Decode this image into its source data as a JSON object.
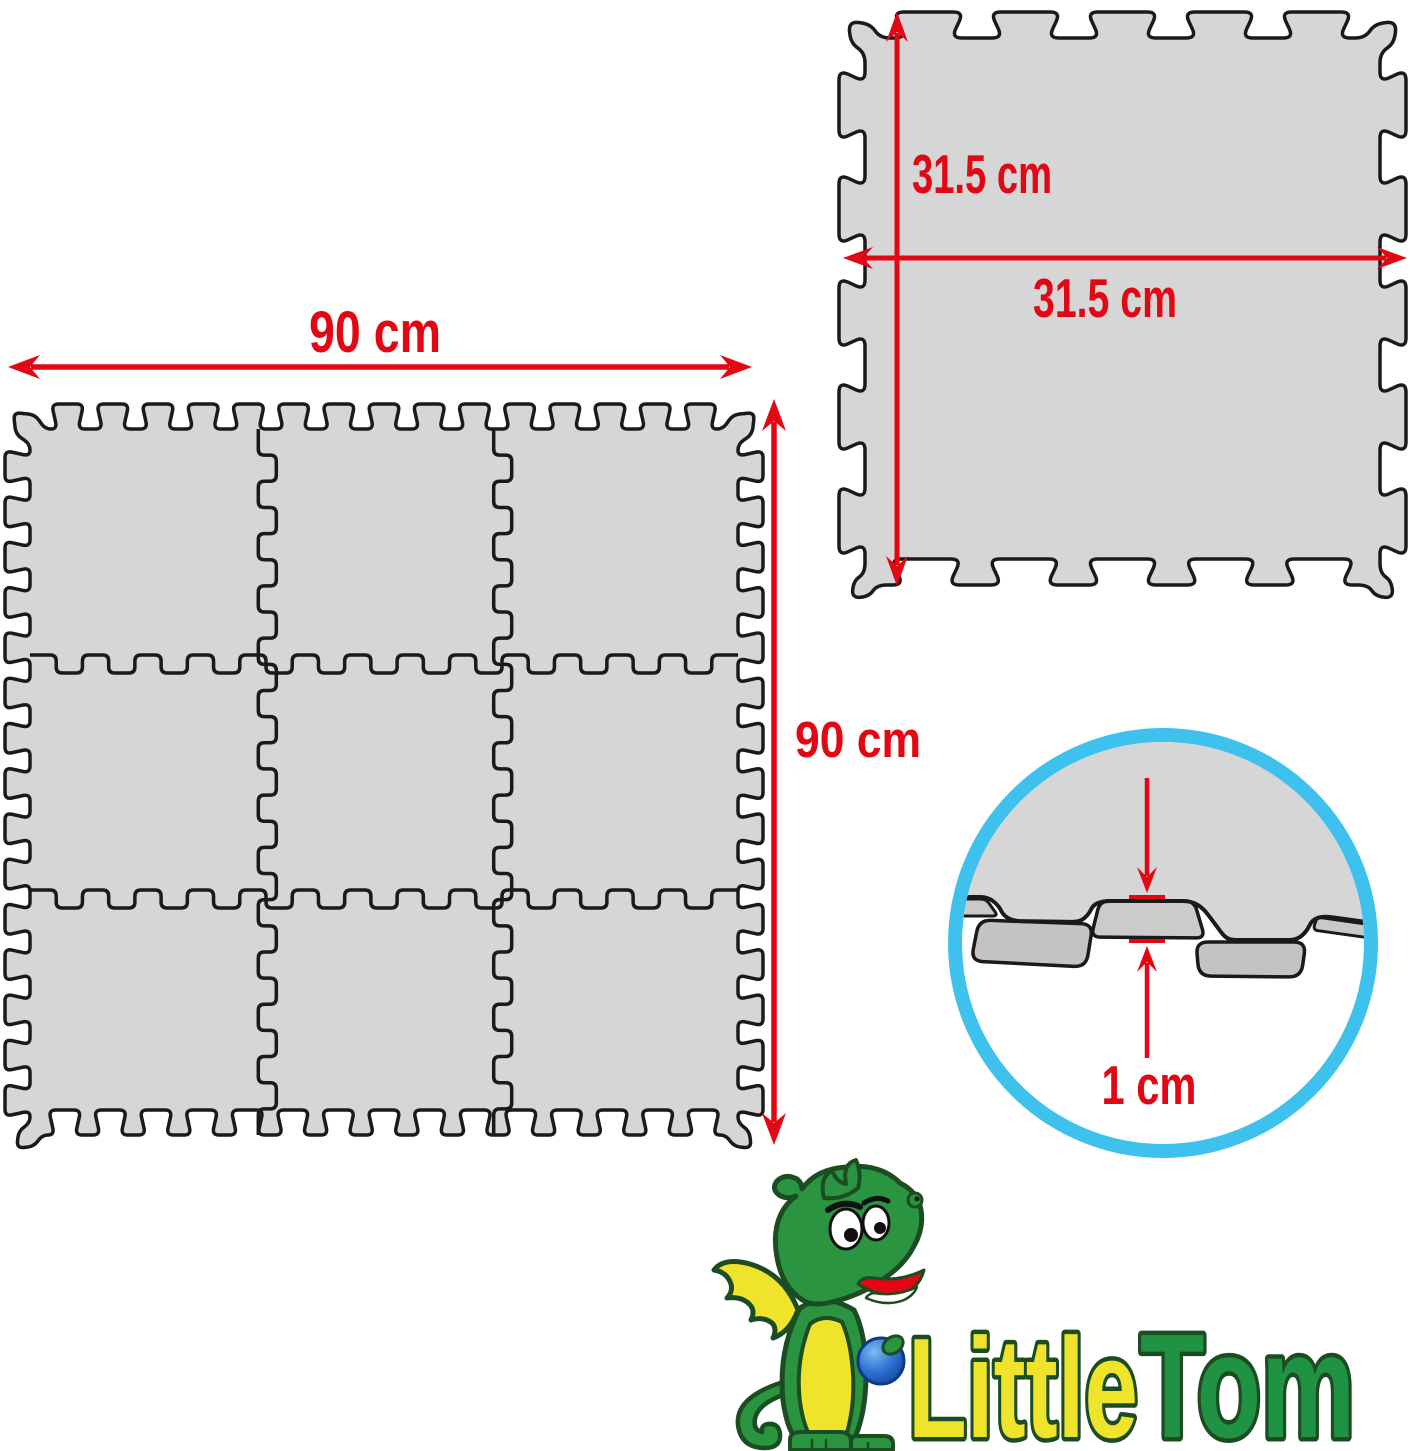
{
  "colors": {
    "background": "#ffffff",
    "red": "#e30613",
    "outline": "#1a1a1a",
    "mat_fill": "#d6d6d6",
    "mat_face": "#c3c3c3",
    "mat_face_mid": "#cbcbcb",
    "mat_strip": "#c9c9c9",
    "circle_blue": "#3fc1ee",
    "logo_green": "#1f9243",
    "logo_dark_green": "#1c4d22",
    "logo_yellow": "#efe32b",
    "dragon_green": "#2a9440",
    "ball_blue": "#1a5fc8",
    "white": "#ffffff"
  },
  "grid_diagram": {
    "rows": 3,
    "cols": 3,
    "tile_count": 9,
    "width_label": "90 cm",
    "height_label": "90 cm"
  },
  "tile_diagram": {
    "width_label": "31.5 cm",
    "height_label": "31.5 cm"
  },
  "thickness_detail": {
    "thickness_label": "1 cm"
  },
  "logo": {
    "word_1": "Little",
    "word_2": "Tom"
  }
}
